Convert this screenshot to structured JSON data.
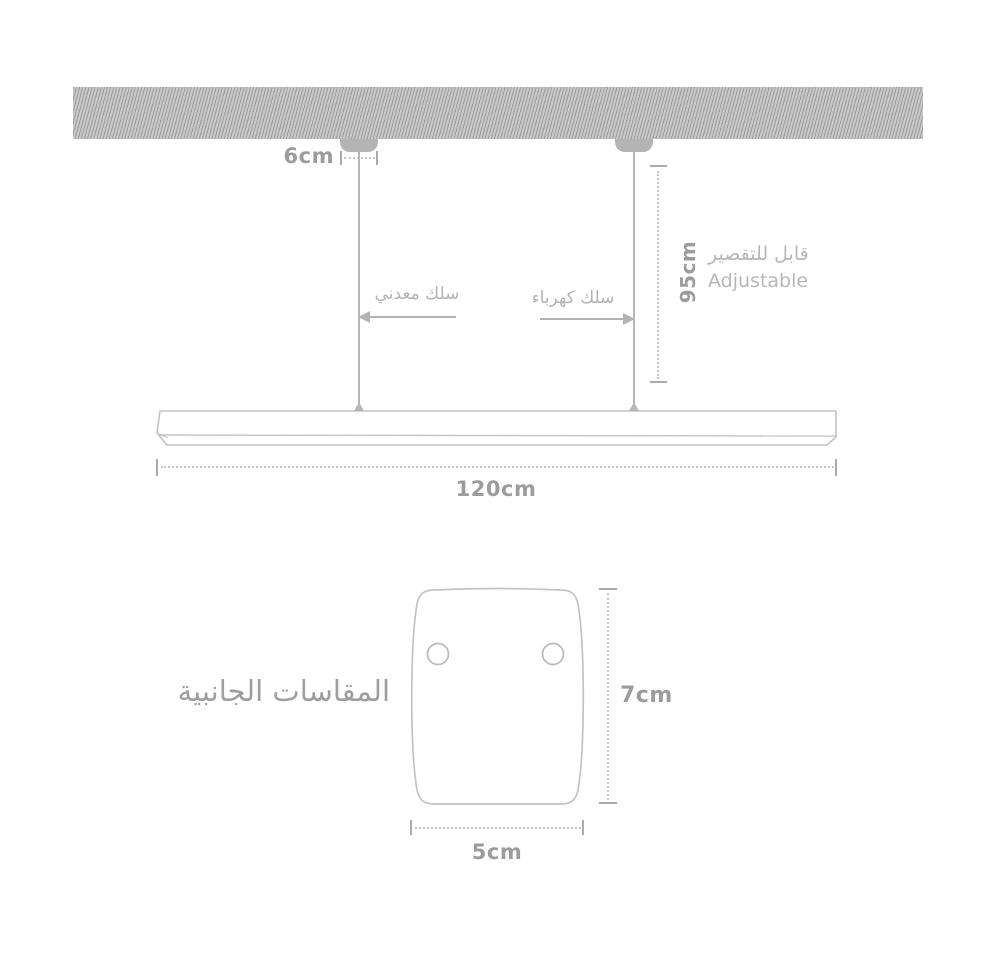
{
  "meta": {
    "type": "product-dimension-diagram",
    "background": "#ffffff"
  },
  "colors": {
    "hatch_base": "#c9c9c9",
    "hatch_stripe": "#9e9e9e",
    "canopy": "#b4b4b4",
    "outline": "#c3c3c3",
    "wire": "#b7b7b7",
    "dim_text": "#9c9c9c",
    "label_text": "#b3b3b3",
    "title_text": "#9e9e9e"
  },
  "pendant_view": {
    "canopy_spacing": {
      "value": "6cm"
    },
    "cable_drop": {
      "value": "95cm"
    },
    "adjustable": {
      "ar": "قابل للتقصير",
      "en": "Adjustable"
    },
    "metal_wire": {
      "label": "سلك معدني",
      "icon": "arrow-left-icon"
    },
    "electric_wire": {
      "label": "سلك كهرباء",
      "icon": "arrow-right-icon"
    },
    "fixture_length": {
      "value": "120cm"
    }
  },
  "side_view": {
    "title": "المقاسات الجانبية",
    "height": {
      "value": "7cm"
    },
    "width": {
      "value": "5cm"
    },
    "mounting_holes": 2
  }
}
